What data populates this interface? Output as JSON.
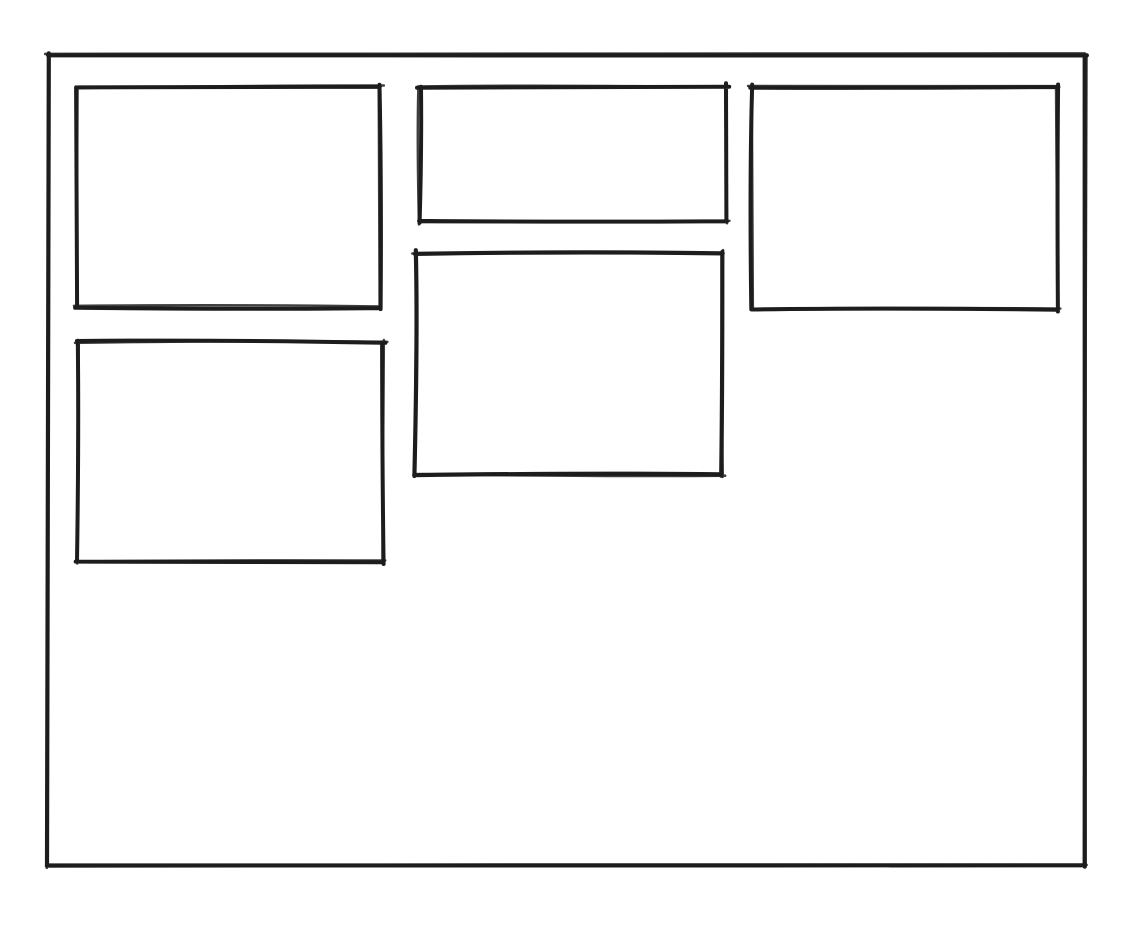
{
  "canvas": {
    "width": 1144,
    "height": 938,
    "background": "#ffffff",
    "stroke_color": "#1d1d1d"
  },
  "wireframe": {
    "frame": {
      "name": "outer-frame",
      "x": 48,
      "y": 55,
      "w": 1037,
      "h": 811,
      "stroke_width": 4.2
    },
    "panels": [
      {
        "name": "panel-top-left",
        "x": 77,
        "y": 87,
        "w": 303,
        "h": 220,
        "stroke_width": 4.0
      },
      {
        "name": "panel-top-center",
        "x": 420,
        "y": 87,
        "w": 306,
        "h": 134,
        "stroke_width": 4.0
      },
      {
        "name": "panel-top-right",
        "x": 752,
        "y": 87,
        "w": 305,
        "h": 222,
        "stroke_width": 4.0
      },
      {
        "name": "panel-mid-center",
        "x": 415,
        "y": 253,
        "w": 307,
        "h": 222,
        "stroke_width": 4.2
      },
      {
        "name": "panel-mid-left",
        "x": 78,
        "y": 342,
        "w": 305,
        "h": 220,
        "stroke_width": 4.0
      }
    ]
  }
}
